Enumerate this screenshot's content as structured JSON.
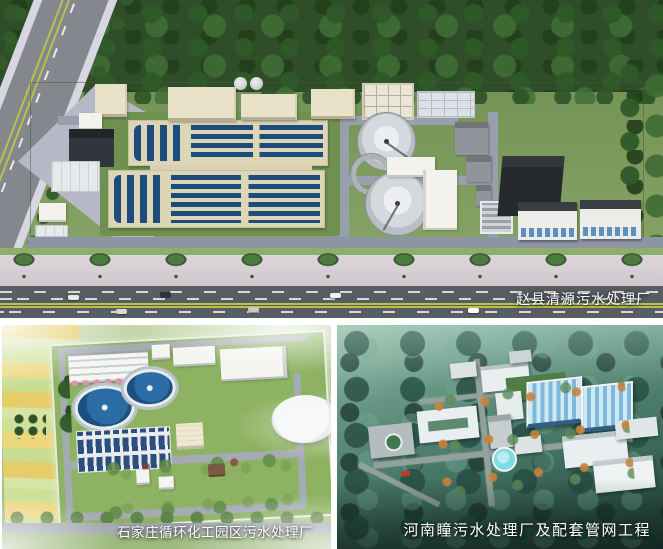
{
  "gallery": {
    "items": [
      {
        "position": "top",
        "caption": "赵县清源污水处理厂"
      },
      {
        "position": "bottom-left",
        "caption": "石家庄循环化工园区污水处理厂"
      },
      {
        "position": "bottom-right",
        "caption": "河南瞳污水处理厂及配套管网工程"
      }
    ]
  },
  "colors": {
    "basin_water_blue": "#1c4c7c",
    "basin_wall_cream": "#dcd5b6",
    "grass_green": "#7c9b5f",
    "tree_dark_green": "#2f4d29",
    "pavement_lavender_gray": "#b6b8c5",
    "asphalt_road": "#585d64",
    "forest_teal": "#3f6f60",
    "membrane_cover_blue": "#7fb8d8",
    "clarifier_water_blue": "#2a6ca3",
    "field_yellow": "#e5cd69",
    "caption_text": "#ffffff"
  }
}
